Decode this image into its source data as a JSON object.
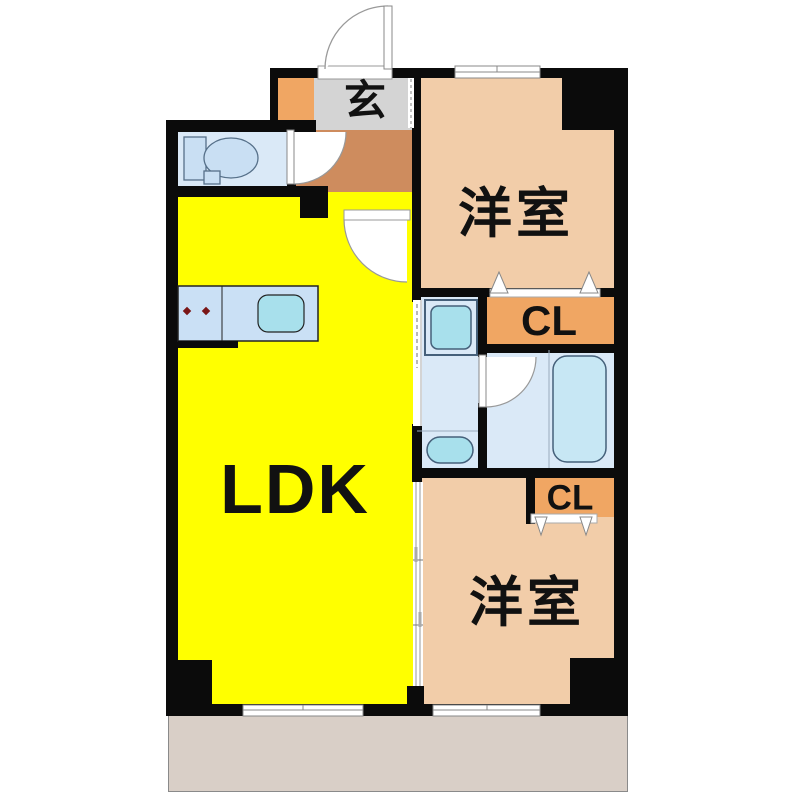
{
  "floor_plan": {
    "title": "Japanese apartment floor plan (1LDK-style layout with two western rooms)",
    "rooms": {
      "ldk": {
        "label": "LDK"
      },
      "entrance": {
        "label": "玄"
      },
      "bedroom_top": {
        "label": "洋室"
      },
      "bedroom_bottom": {
        "label": "洋室"
      },
      "closet_top": {
        "label": "CL"
      },
      "closet_bottom": {
        "label": "CL"
      }
    },
    "colors": {
      "wall": "#0b0b0b",
      "ldk": "#ffff00",
      "bedroom": "#f2cda9",
      "closet": "#f0a663",
      "hallway": "#ce8c5e",
      "entrance_floor": "#d4d4d4",
      "shoe_cabinet": "#f0a663",
      "wet_area": "#dae9f7",
      "counter": "#cae0f5",
      "fixture": "#a8e0ec",
      "bathtub": "#c7e7f4",
      "balcony": "#d9cfc7",
      "text": "#111111"
    },
    "icons": [
      "entrance-door-swing-icon",
      "toilet-icon",
      "toilet-door-icon",
      "ldk-door-icon",
      "kitchen-counter-icon",
      "stove-burner-icon",
      "washroom-sliding-door-icon",
      "washing-machine-icon",
      "washbasin-icon",
      "bathroom-door-icon",
      "bathtub-icon",
      "closet-folding-door-icon",
      "sliding-partition-icon",
      "sliding-window-icon"
    ]
  }
}
